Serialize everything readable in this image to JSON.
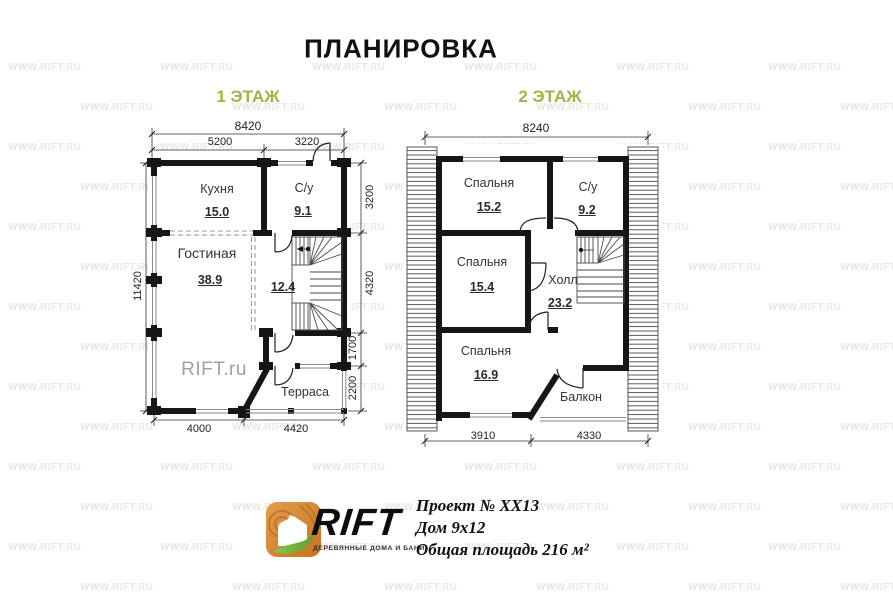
{
  "title": "ПЛАНИРОВКА",
  "watermark": {
    "text": "WWW.RIFT.RU"
  },
  "floor1": {
    "heading": "1 ЭТАЖ",
    "width_total": "8420",
    "sub_widths": [
      "5200",
      "3220"
    ],
    "height_total": "11420",
    "right_chain": [
      "3200",
      "4320",
      "1700",
      "2200"
    ],
    "bottom_widths": [
      "4000",
      "4420"
    ],
    "rooms": [
      {
        "name": "Кухня",
        "area": "15.0"
      },
      {
        "name": "С/у",
        "area": "9.1"
      },
      {
        "name": "Гостиная",
        "area": "38.9"
      },
      {
        "name": "Холл",
        "area": "12.4"
      },
      {
        "name": "Терраса",
        "area": ""
      }
    ],
    "inline_watermark": "RIFT.ru"
  },
  "floor2": {
    "heading": "2 ЭТАЖ",
    "width_total": "8240",
    "bottom_widths": [
      "3910",
      "4330"
    ],
    "rooms": [
      {
        "name": "Спальня",
        "area": "15.2"
      },
      {
        "name": "С/у",
        "area": "9.2"
      },
      {
        "name": "Спальня",
        "area": "15.4"
      },
      {
        "name": "Холл",
        "area": "23.2"
      },
      {
        "name": "Спальня",
        "area": "16.9"
      },
      {
        "name": "Балкон",
        "area": ""
      }
    ]
  },
  "footer": {
    "brand": "RIFT",
    "tagline": "ДЕРЕВЯННЫЕ ДОМА И БАНИ",
    "project": "Проект № XX13",
    "house": "Дом 9x12",
    "total_area": "Общая площадь 216 м²"
  },
  "colors": {
    "heading_green": "#9ab845",
    "wall": "#161616",
    "watermark": "#e9e7df",
    "logo_orange": "#d9822b",
    "logo_leaf": "#76b043"
  }
}
